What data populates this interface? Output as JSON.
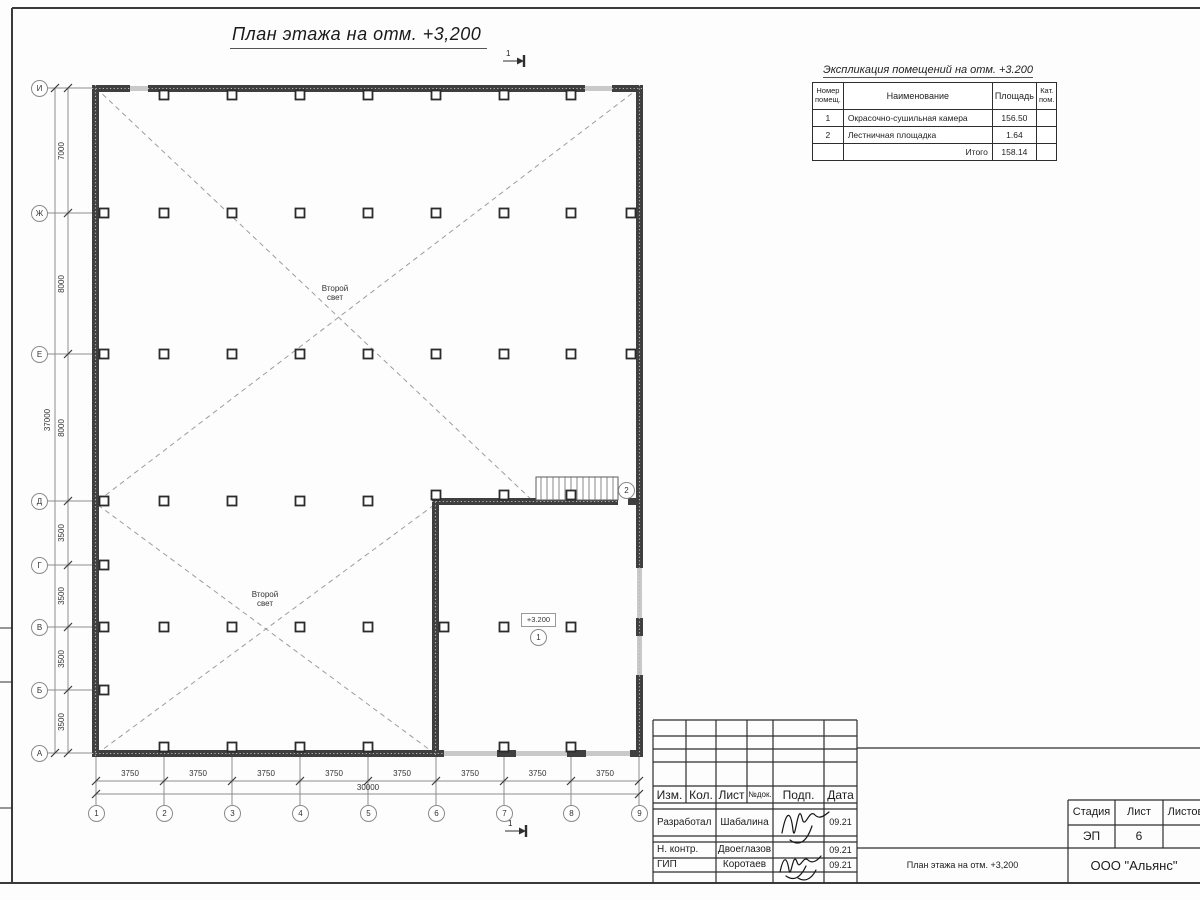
{
  "drawing": {
    "title": "План этажа на отм. +3,200",
    "section_mark": "1",
    "second_light": "Второй свет",
    "elevation_mark": "+3.200",
    "room_numbers": [
      "1",
      "2"
    ]
  },
  "axes": {
    "row_labels": [
      "И",
      "Ж",
      "Е",
      "Д",
      "Г",
      "В",
      "Б",
      "А"
    ],
    "col_labels": [
      "1",
      "2",
      "3",
      "4",
      "5",
      "6",
      "7",
      "8",
      "9"
    ]
  },
  "dimensions": {
    "vertical": [
      "7000",
      "8000",
      "8000",
      "3500",
      "3500",
      "3500",
      "3500"
    ],
    "vertical_total": "37000",
    "horizontal": [
      "3750",
      "3750",
      "3750",
      "3750",
      "3750",
      "3750",
      "3750",
      "3750"
    ],
    "horizontal_total": "30000"
  },
  "explication": {
    "title": "Экспликация помещений на отм. +3.200",
    "headers": {
      "number": "Номер помещ.",
      "name": "Наименование",
      "area": "Площадь",
      "cat": "Кат. пом."
    },
    "rows": [
      {
        "number": "1",
        "name": "Окрасочно-сушильная камера",
        "area": "156.50"
      },
      {
        "number": "2",
        "name": "Лестничная площадка",
        "area": "1.64"
      }
    ],
    "total_label": "Итого",
    "total_area": "158.14"
  },
  "title_block": {
    "columns": [
      "Изм.",
      "Кол.",
      "Лист",
      "№док.",
      "Подп.",
      "Дата"
    ],
    "rows": [
      {
        "role": "Разработал",
        "name": "Шабалина",
        "date": "09.21"
      },
      {
        "role": "Н. контр.",
        "name": "Двоеглазов",
        "date": "09.21"
      },
      {
        "role": "ГИП",
        "name": "Коротаев",
        "date": "09.21"
      }
    ],
    "stage_label": "Стадия",
    "sheet_label": "Лист",
    "sheets_label": "Листов",
    "stage": "ЭП",
    "sheet": "6",
    "doc_title": "План этажа на отм. +3,200",
    "company": "ООО \"Альянс\""
  }
}
